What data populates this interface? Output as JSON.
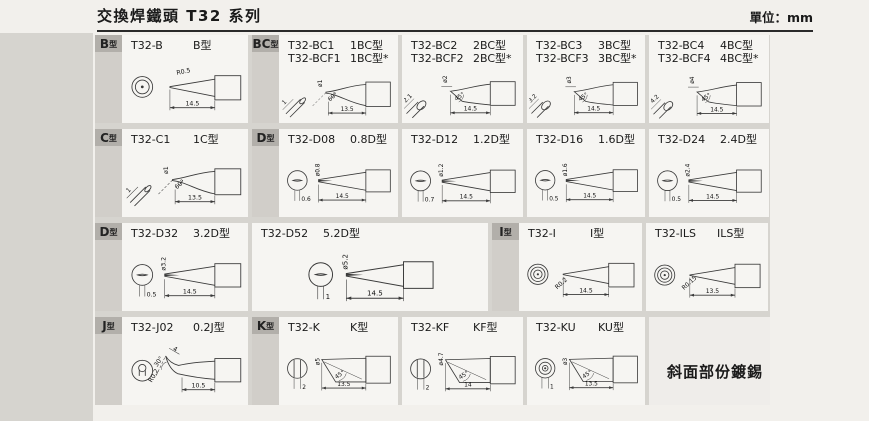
{
  "page": {
    "title": "交換焊鐵頭 T32 系列",
    "unit": "單位：mm",
    "note": "斜面部份鍍錫"
  },
  "colors": {
    "bg": "#f2f0ec",
    "gutter": "#d6d4cf",
    "cell": "#f6f5f2",
    "badge": "#b2afaa",
    "strip": "#d1cec9",
    "line": "#3a3a3a",
    "text": "#1a1a1a"
  },
  "grid": {
    "rows": [
      {
        "cells": [
          {
            "w": 153,
            "badge": "B型",
            "models": [
              {
                "name": "T32-B",
                "type": "B型"
              }
            ],
            "drawing": {
              "kind": "cone",
              "labels": {
                "radius": "R0.5",
                "len": "14.5"
              }
            }
          },
          {
            "w": 146,
            "badge": "BC型",
            "models": [
              {
                "name": "T32-BC1",
                "type": "1BC型"
              },
              {
                "name": "T32-BCF1",
                "type": "1BC型*"
              }
            ],
            "drawing": {
              "kind": "bevelAngled",
              "labels": {
                "dia": "ø1",
                "tip": "1",
                "angle": "60°",
                "len": "13.5"
              }
            }
          },
          {
            "w": 121,
            "models": [
              {
                "name": "T32-BC2",
                "type": "2BC型"
              },
              {
                "name": "T32-BCF2",
                "type": "2BC型*"
              }
            ],
            "drawing": {
              "kind": "bevel",
              "labels": {
                "dia": "ø2",
                "tip": "2.1",
                "angle": "45°",
                "len": "14.5"
              }
            }
          },
          {
            "w": 118,
            "models": [
              {
                "name": "T32-BC3",
                "type": "3BC型"
              },
              {
                "name": "T32-BCF3",
                "type": "3BC型*"
              }
            ],
            "drawing": {
              "kind": "bevel",
              "labels": {
                "dia": "ø3",
                "tip": "3.2",
                "angle": "45°",
                "len": "14.5"
              }
            }
          },
          {
            "w": 120,
            "models": [
              {
                "name": "T32-BC4",
                "type": "4BC型"
              },
              {
                "name": "T32-BCF4",
                "type": "4BC型*"
              }
            ],
            "drawing": {
              "kind": "bevel",
              "labels": {
                "dia": "ø4",
                "tip": "4.2",
                "angle": "45°",
                "len": "14.5"
              }
            }
          }
        ]
      },
      {
        "cells": [
          {
            "w": 153,
            "badge": "C型",
            "models": [
              {
                "name": "T32-C1",
                "type": "1C型"
              }
            ],
            "drawing": {
              "kind": "bevelAngled",
              "labels": {
                "dia": "ø1",
                "tip": "1",
                "angle": "60°",
                "len": "13.5"
              }
            }
          },
          {
            "w": 146,
            "badge": "D型",
            "models": [
              {
                "name": "T32-D08",
                "type": "0.8D型"
              }
            ],
            "drawing": {
              "kind": "chisel",
              "labels": {
                "dia": "ø0.8",
                "width": "0.6",
                "len": "14.5"
              }
            }
          },
          {
            "w": 121,
            "models": [
              {
                "name": "T32-D12",
                "type": "1.2D型"
              }
            ],
            "drawing": {
              "kind": "chisel",
              "labels": {
                "dia": "ø1.2",
                "width": "0.7",
                "len": "14.5"
              }
            }
          },
          {
            "w": 118,
            "models": [
              {
                "name": "T32-D16",
                "type": "1.6D型"
              }
            ],
            "drawing": {
              "kind": "chisel",
              "labels": {
                "dia": "ø1.6",
                "width": "0.5",
                "len": "14.5"
              }
            }
          },
          {
            "w": 120,
            "models": [
              {
                "name": "T32-D24",
                "type": "2.4D型"
              }
            ],
            "drawing": {
              "kind": "chisel",
              "labels": {
                "dia": "ø2.4",
                "width": "0.5",
                "len": "14.5"
              }
            }
          }
        ]
      },
      {
        "cells": [
          {
            "w": 153,
            "badge": "D型",
            "models": [
              {
                "name": "T32-D32",
                "type": "3.2D型"
              }
            ],
            "drawing": {
              "kind": "chisel",
              "labels": {
                "dia": "ø3.2",
                "width": "0.5",
                "len": "14.5"
              }
            }
          },
          {
            "w": 236,
            "models": [
              {
                "name": "T32-D52",
                "type": "5.2D型"
              }
            ],
            "drawing": {
              "kind": "chisel",
              "labels": {
                "dia": "ø5.2",
                "width": "1",
                "len": "14.5"
              }
            }
          },
          {
            "w": 150,
            "badge": "I型",
            "models": [
              {
                "name": "T32-I",
                "type": "I型"
              }
            ],
            "drawing": {
              "kind": "needle",
              "labels": {
                "radius": "R0.2",
                "len": "14.5"
              }
            }
          },
          {
            "w": 122,
            "models": [
              {
                "name": "T32-ILS",
                "type": "ILS型"
              }
            ],
            "drawing": {
              "kind": "needle",
              "labels": {
                "radius": "R0.15",
                "len": "13.5"
              }
            }
          }
        ]
      },
      {
        "cells": [
          {
            "w": 153,
            "badge": "J型",
            "models": [
              {
                "name": "T32-J02",
                "type": "0.2J型"
              }
            ],
            "drawing": {
              "kind": "bent",
              "labels": {
                "top": "4",
                "angle": "30°",
                "radius": "R0.2",
                "len": "10.5"
              }
            }
          },
          {
            "w": 146,
            "badge": "K型",
            "models": [
              {
                "name": "T32-K",
                "type": "K型"
              }
            ],
            "drawing": {
              "kind": "knife",
              "labels": {
                "dia": "ø5",
                "width": "2",
                "angle": "45°",
                "len": "13.5",
                "front_view": "chords"
              }
            }
          },
          {
            "w": 121,
            "models": [
              {
                "name": "T32-KF",
                "type": "KF型"
              }
            ],
            "drawing": {
              "kind": "knife",
              "labels": {
                "dia": "ø4.7",
                "width": "2",
                "angle": "45°",
                "len": "14",
                "front_view": "chords"
              }
            }
          },
          {
            "w": 118,
            "models": [
              {
                "name": "T32-KU",
                "type": "KU型"
              }
            ],
            "drawing": {
              "kind": "knife",
              "labels": {
                "dia": "ø3",
                "width": "1",
                "angle": "45°",
                "len": "13.5",
                "front_view": "rings"
              }
            }
          }
        ]
      }
    ]
  }
}
